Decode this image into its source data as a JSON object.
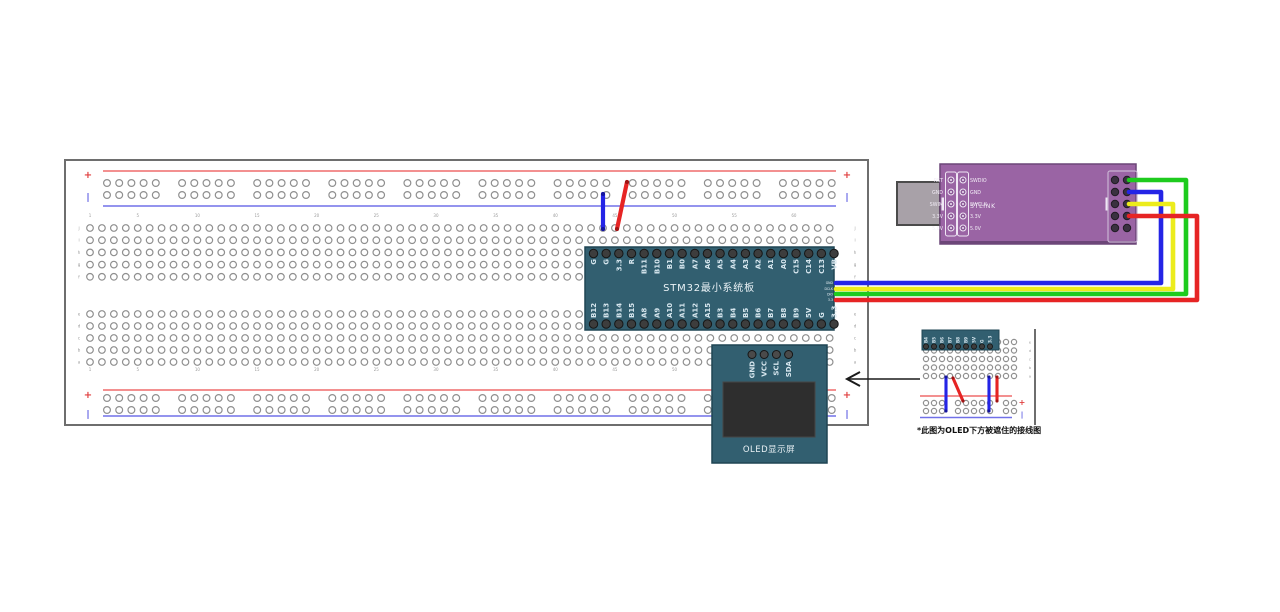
{
  "colors": {
    "board_teal": "#325f70",
    "board_teal_border": "#1f4553",
    "stlink_purple": "#9a64a4",
    "stlink_purple_dark": "#6c4678",
    "usb_gray": "#a8a1a8",
    "usb_border": "#4b4b4b",
    "hole_ring": "#8f8f8f",
    "pin_dark": "#3d3d3d",
    "pin_ring": "#161616",
    "pin_label": "#d6e6ee",
    "rail_red": "#ef6b6b",
    "rail_blue": "#7070e8",
    "mark_red": "#e04040",
    "mark_blue": "#5050e0",
    "bb_border": "#6e6e6e",
    "tick_gray": "#9a9a9a",
    "wire_red": "#e62424",
    "wire_blue": "#2424e6",
    "wire_green": "#1ecb1e",
    "wire_yellow": "#ecec1c",
    "arrow_black": "#1a1a1a"
  },
  "breadboard_main": {
    "x": 65,
    "y": 160,
    "w": 803,
    "h": 265,
    "rail_x1": 103,
    "rail_x2": 836,
    "rail_top": {
      "red_y": 171,
      "blue_y": 206,
      "hole_rows": [
        183,
        195
      ]
    },
    "rail_bottom": {
      "red_y": 390,
      "blue_y": 416,
      "hole_rows": [
        398,
        410
      ]
    },
    "rail_hole_start": 107,
    "rail_group_pitch": 75.1,
    "rail_hole_dx": 12.2,
    "rail_groups": 10,
    "grid": {
      "x0": 90,
      "dx": 11.93,
      "cols": 63,
      "rows_top": [
        228,
        240.2,
        252.4,
        264.6,
        276.8
      ],
      "rows_bottom": [
        314,
        326,
        338,
        350,
        362
      ]
    },
    "col_numbers": [
      "1",
      "5",
      "10",
      "15",
      "20",
      "25",
      "30",
      "35",
      "40",
      "45",
      "50",
      "55",
      "60"
    ],
    "col_number_y": [
      217,
      371
    ],
    "row_letters_top": [
      "j",
      "i",
      "h",
      "g",
      "f"
    ],
    "row_letters_bottom": [
      "e",
      "d",
      "c",
      "b",
      "a"
    ],
    "letter_x": [
      79,
      855
    ],
    "plus": "+",
    "minus": "|",
    "marks": [
      {
        "t": "+",
        "x": 88,
        "y": 178,
        "c": "red"
      },
      {
        "t": "|",
        "x": 88,
        "y": 200,
        "c": "blue"
      },
      {
        "t": "+",
        "x": 847,
        "y": 178,
        "c": "red"
      },
      {
        "t": "|",
        "x": 847,
        "y": 200,
        "c": "blue"
      },
      {
        "t": "+",
        "x": 88,
        "y": 398,
        "c": "red"
      },
      {
        "t": "|",
        "x": 88,
        "y": 417,
        "c": "blue"
      },
      {
        "t": "+",
        "x": 847,
        "y": 398,
        "c": "red"
      },
      {
        "t": "|",
        "x": 847,
        "y": 417,
        "c": "blue"
      }
    ]
  },
  "stm32": {
    "title": "STM32最小系统板",
    "x": 585,
    "y": 247,
    "w": 249,
    "h": 83,
    "pin_x0": 593.5,
    "pin_dx": 12.66,
    "top_pin_y": 253.5,
    "bottom_pin_y": 324,
    "top_pins": [
      "G",
      "G",
      "3.3",
      "R",
      "B11",
      "B10",
      "B1",
      "B0",
      "A7",
      "A6",
      "A5",
      "A4",
      "A3",
      "A2",
      "A1",
      "A0",
      "C15",
      "C14",
      "C13",
      "VB"
    ],
    "bottom_pins": [
      "B12",
      "B13",
      "B14",
      "B15",
      "A8",
      "A9",
      "A10",
      "A11",
      "A12",
      "A15",
      "B3",
      "B4",
      "B5",
      "B6",
      "B7",
      "B8",
      "B9",
      "5V",
      "G",
      "3.3"
    ],
    "swd_pins": [
      "GND",
      "DCLK",
      "DIO",
      "3.3"
    ],
    "swd_y": [
      283,
      288.7,
      294.4,
      300
    ],
    "swd_label_x": 833
  },
  "oled": {
    "title": "OLED显示屏",
    "x": 712,
    "y": 345,
    "w": 115,
    "h": 118,
    "pins": [
      "GND",
      "VCC",
      "SCL",
      "SDA"
    ],
    "pin_x0": 752,
    "pin_dx": 12.2,
    "pin_y": 354.5,
    "screen": {
      "x": 723,
      "y": 382,
      "w": 92,
      "h": 55
    }
  },
  "stlink": {
    "title": "STLINK",
    "x": 940,
    "y": 164,
    "w": 196,
    "h": 80,
    "usb": {
      "x": 897,
      "y": 182,
      "w": 43,
      "h": 43
    },
    "left_labels": [
      "RST",
      "GND",
      "SWIM",
      "3.3V",
      "5.0V"
    ],
    "right_labels": [
      "SWDIO",
      "GND",
      "SWCLK",
      "3.3V",
      "5.0V"
    ],
    "rows_y": [
      180,
      192,
      204,
      216,
      228
    ],
    "inner_cols_x": [
      951,
      963
    ],
    "inner_boxes": [
      {
        "x": 945.5,
        "y": 172,
        "w": 11,
        "h": 64
      },
      {
        "x": 957.5,
        "y": 172,
        "w": 11,
        "h": 64
      }
    ],
    "notches": [
      {
        "x": 941.5,
        "y": 197.5,
        "w": 2.5,
        "h": 13
      },
      {
        "x": 1105.5,
        "y": 197.5,
        "w": 2.5,
        "h": 13
      }
    ],
    "header": {
      "x": 1108,
      "y": 171,
      "w": 29,
      "h": 71,
      "cols_x": [
        1115,
        1127
      ]
    }
  },
  "breadboard_mini": {
    "x": 920,
    "y": 329,
    "w": 116,
    "h": 96,
    "edge_x": 1035,
    "board_chunk": {
      "x": 922,
      "y": 330,
      "w": 77,
      "h": 20
    },
    "pins": [
      "B4",
      "B5",
      "B6",
      "B7",
      "B8",
      "B9",
      "5V",
      "G",
      "3.3"
    ],
    "pin_x0": 926,
    "pin_dx": 8,
    "pin_y": 346.5,
    "grid": {
      "x0": 926,
      "dx": 8,
      "cols": 12,
      "rows": [
        342,
        350.5,
        359,
        367.5,
        376
      ]
    },
    "rail": {
      "red_y": 396,
      "blue_y": 417.5,
      "hole_rows": [
        403,
        411
      ],
      "x1": 920,
      "x2": 1012
    },
    "rail_hole_groups": [
      [
        926,
        934,
        942
      ],
      [
        958,
        966,
        974,
        982,
        990
      ],
      [
        1006,
        1014
      ]
    ],
    "marks": [
      {
        "t": "+",
        "x": 1022,
        "y": 405,
        "c": "red"
      },
      {
        "t": "|",
        "x": 1022,
        "y": 417,
        "c": "blue"
      }
    ],
    "row_letters": [
      "e",
      "d",
      "c",
      "b",
      "a"
    ],
    "letter_x": 1030
  },
  "mini_board": {
    "caption": "*此图为OLED下方被遮住的接线图"
  },
  "wires": [
    {
      "name": "wire-bb-gnd-to-rail",
      "from": "minus rail",
      "to": "column of STM32 G",
      "color": "#2424e6",
      "width": 4.2,
      "dot": "#14149e",
      "points": [
        [
          603,
          194
        ],
        [
          603,
          229
        ]
      ]
    },
    {
      "name": "wire-bb-33-to-rail",
      "from": "plus rail",
      "to": "column of STM32 3.3",
      "color": "#e62424",
      "width": 4.2,
      "dot": "#9e1414",
      "points": [
        [
          627,
          182
        ],
        [
          617,
          229
        ]
      ]
    },
    {
      "name": "wire-swdio",
      "from": "STM32 DIO",
      "to": "STLINK SWDIO",
      "color": "#1ecb1e",
      "width": 4.6,
      "points": [
        [
          836,
          294
        ],
        [
          1186,
          294
        ],
        [
          1186,
          180
        ],
        [
          1129,
          180
        ]
      ]
    },
    {
      "name": "wire-gnd",
      "from": "STM32 GND",
      "to": "STLINK GND",
      "color": "#2424e6",
      "width": 4.6,
      "points": [
        [
          836,
          283
        ],
        [
          1161,
          283
        ],
        [
          1161,
          192
        ],
        [
          1129,
          192
        ]
      ]
    },
    {
      "name": "wire-swclk",
      "from": "STM32 DCLK",
      "to": "STLINK SWCLK",
      "color": "#ecec1c",
      "width": 4.6,
      "points": [
        [
          836,
          289
        ],
        [
          1173,
          289
        ],
        [
          1173,
          204
        ],
        [
          1129,
          204
        ]
      ]
    },
    {
      "name": "wire-33v",
      "from": "STM32 3.3",
      "to": "STLINK 3.3V",
      "color": "#e62424",
      "width": 4.6,
      "points": [
        [
          836,
          300
        ],
        [
          1197,
          300
        ],
        [
          1197,
          216
        ],
        [
          1129,
          216
        ]
      ]
    },
    {
      "name": "mini-wire-oled-gnd",
      "from": "OLED GND column",
      "to": "minus rail",
      "color": "#2424e6",
      "width": 3.1,
      "dot": "#14149e",
      "points": [
        [
          946,
          377
        ],
        [
          946,
          411
        ]
      ]
    },
    {
      "name": "mini-wire-oled-vcc",
      "from": "OLED VCC column",
      "to": "plus rail",
      "color": "#e62424",
      "width": 3.1,
      "dot": "#9e1414",
      "points": [
        [
          953,
          378
        ],
        [
          963,
          401
        ]
      ]
    },
    {
      "name": "mini-wire-g-to-rail",
      "from": "STM32 G column",
      "to": "minus rail",
      "color": "#2424e6",
      "width": 3.1,
      "dot": "#14149e",
      "points": [
        [
          989,
          377
        ],
        [
          989,
          411
        ]
      ]
    },
    {
      "name": "mini-wire-33-to-rail",
      "from": "STM32 3.3 column",
      "to": "plus rail",
      "color": "#e62424",
      "width": 3.1,
      "dot": "#9e1414",
      "points": [
        [
          997,
          377
        ],
        [
          997,
          401
        ]
      ]
    }
  ],
  "arrow": {
    "x1": 920,
    "y1": 379,
    "x2": 847,
    "y2": 379
  }
}
